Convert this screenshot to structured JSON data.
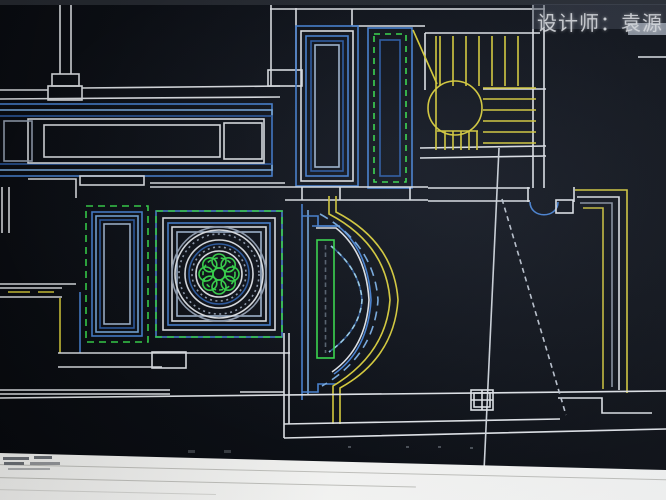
{
  "watermark": {
    "text": "设计师：袁源"
  },
  "palette": {
    "wall": "#e8ebef",
    "wall-dim": "#9aa6b8",
    "blue": "#4a86d8",
    "blue-light": "#7db0e4",
    "blue-dark": "#2f5fa8",
    "blue-pale": "#a9bfd9",
    "blue-glow": "#9fd4f2",
    "green": "#3ae04e",
    "yellow": "#ded23c",
    "yellow-dim": "#cfc33a",
    "gray-line": "#8d96a4",
    "fill-pale": "#c9d3df",
    "watermark": "#e0e2e5",
    "canvas-bg": "#0c0f15"
  }
}
